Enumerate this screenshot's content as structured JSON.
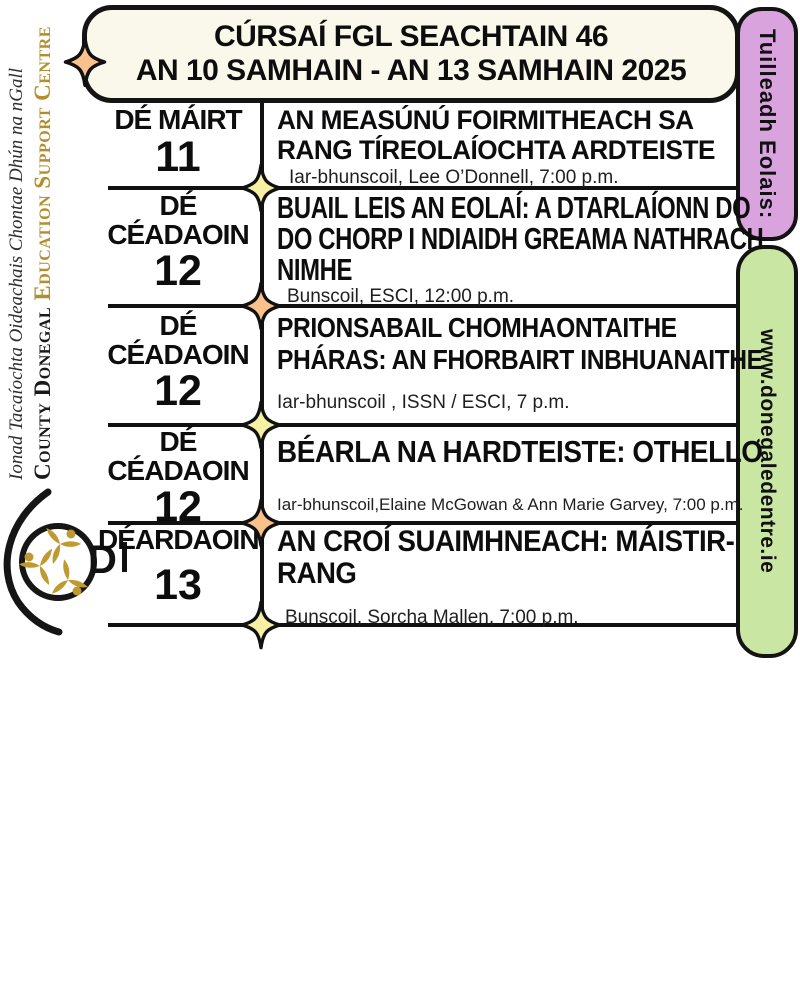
{
  "sidebar": {
    "irish_name": "Ionad Tacaíochta Oideachais Chontae Dhún na nGall",
    "english_name_part1": "County Donegal",
    "english_name_part2": "Education Support Centre",
    "clipped_text": "D",
    "colors": {
      "gold": "#B28F2C",
      "logo_gold": "#BE9A30",
      "black": "#1A1A1A"
    }
  },
  "header": {
    "line1": "CÚRSAÍ FGL SEACHTAIN 46",
    "line2": "AN 10 SAMHAIN -  AN 13 SAMHAIN 2025",
    "background": "#FAF7EB"
  },
  "side_tabs": {
    "info": {
      "label": "Tuilleadh Eolais:",
      "background": "#D9A3DE"
    },
    "website": {
      "label": "www.donegaledentre.ie",
      "background": "#C9E6A3"
    }
  },
  "schedule": {
    "rows": [
      {
        "day": [
          "DÉ MÁIRT"
        ],
        "date": "11",
        "title": [
          "AN MEASÚNÚ FOIRMITHEACH SA",
          "RANG TÍREOLAÍOCHTA ARDTEISTE"
        ],
        "details": "Iar-bhunscoil, Lee O’Donnell, 7:00 p.m."
      },
      {
        "day": [
          "DÉ",
          "CÉADAOIN"
        ],
        "date": "12",
        "title": [
          "BUAIL LEIS AN EOLAÍ: A DTARLAÍONN DO",
          "DO CHORP I NDIAIDH GREAMA NATHRACH",
          "NIMHE"
        ],
        "details": "Bunscoil, ESCI,  12:00 p.m."
      },
      {
        "day": [
          "DÉ",
          "CÉADAOIN"
        ],
        "date": "12",
        "title": [
          "PRIONSABAIL CHOMHAONTAITHE",
          "PHÁRAS: AN FHORBAIRT INBHUANAITHE"
        ],
        "details": "Iar-bhunscoil , ISSN / ESCI,  7  p.m."
      },
      {
        "day": [
          "DÉ",
          "CÉADAOIN"
        ],
        "date": "12",
        "title": [
          "BÉARLA NA HARDTEISTE: OTHELLO"
        ],
        "details": "Iar-bhunscoil,Elaine McGowan & Ann Marie Garvey, 7:00 p.m."
      },
      {
        "day": [
          "DÉARDAOIN"
        ],
        "date": "13",
        "title": [
          "AN CROÍ SUAIMHNEACH: MÁISTIR-",
          "RANG"
        ],
        "details": "Bunscoil, Sorcha Mallen,  7:00 p.m."
      }
    ]
  },
  "decorations": {
    "star_orange": "#F9C28D",
    "star_yellow": "#F6F0A4",
    "line_color": "#111111"
  }
}
